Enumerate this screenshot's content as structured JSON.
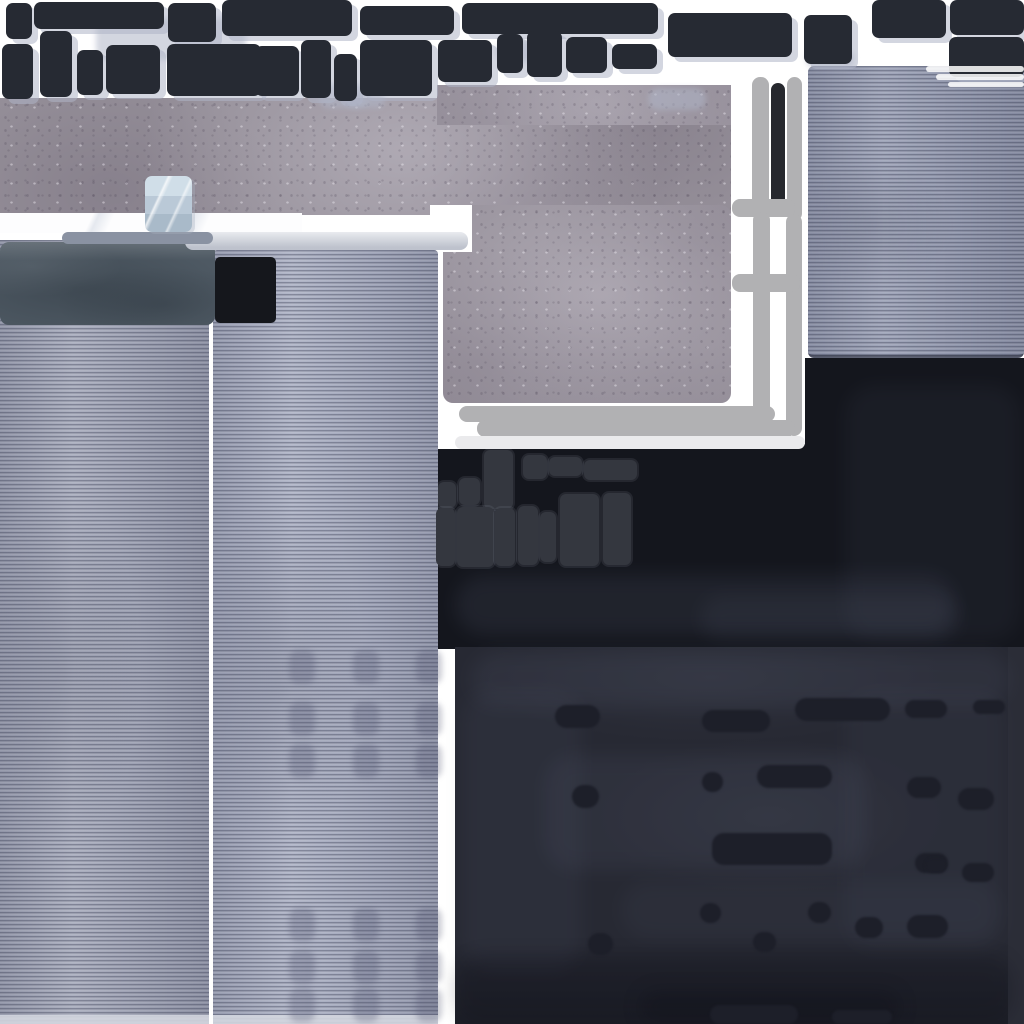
{
  "meta": {
    "asset_kind": "building-texture-atlas",
    "canvas": {
      "width": 1024,
      "height": 1024
    }
  },
  "palette": {
    "bg": "#ffffff",
    "frame": "#262a33",
    "frame_cluster": "#34373f",
    "frame_black": "#15171c",
    "win_shadow": "rgba(174,180,198,0.55)",
    "concrete": "#948e98",
    "panel_left": "#a6aabb",
    "panel_mid": "#acb1c4",
    "panel_right": "#9aa0b5",
    "edge_light": "#d3d6df",
    "cap": "#4e5963",
    "cube_top": "#d0dee8",
    "cube_mid": "#bac9d7",
    "cube_bot": "#a9bac9",
    "bar_blue": "#8a92a2",
    "bar_light": "#ced2db",
    "paint_gray": "#b1b1b3",
    "paint_light": "#eaeaec",
    "black_bar": "#26282e",
    "dark_band": "#14161d",
    "wash_light": "rgba(90,96,118,0.32)",
    "wash_dark": "rgba(10,12,20,0.45)",
    "bottom_base": "#272933",
    "bottom_dash": "#1d1f29",
    "bottom_edge": "#2b2d37"
  },
  "regions": {
    "concrete_band": {
      "x": 0,
      "y": 98,
      "w": 731,
      "h": 117
    },
    "concrete_step": {
      "x": 437,
      "y": 85,
      "w": 294,
      "h": 40
    },
    "concrete_square": {
      "x": 443,
      "y": 205,
      "w": 288,
      "h": 198
    },
    "white_band": {
      "x": 0,
      "y": 213,
      "w": 302,
      "h": 20
    },
    "white_notch": {
      "x": 430,
      "y": 205,
      "w": 42,
      "h": 47
    },
    "panel_right": {
      "x": 808,
      "y": 66,
      "w": 216,
      "h": 292
    },
    "panel_left": {
      "x": 0,
      "y": 240,
      "w": 209,
      "h": 784
    },
    "panel_mid": {
      "x": 213,
      "y": 250,
      "w": 225,
      "h": 774
    },
    "panel_left_edge": {
      "x": 0,
      "y": 1015,
      "w": 209,
      "h": 9
    },
    "panel_mid_edge": {
      "x": 213,
      "y": 1015,
      "w": 225,
      "h": 9
    },
    "cap": {
      "x": 0,
      "y": 242,
      "w": 215,
      "h": 83
    },
    "ac_unit": {
      "x": 145,
      "y": 176,
      "w": 47,
      "h": 56
    },
    "bar_blue": {
      "x": 62,
      "y": 232,
      "w": 151,
      "h": 12
    },
    "bar_light": {
      "x": 185,
      "y": 232,
      "w": 283,
      "h": 18
    },
    "dark_band_main": {
      "x": 438,
      "y": 449,
      "w": 586,
      "h": 200
    },
    "dark_band_right": {
      "x": 805,
      "y": 358,
      "w": 219,
      "h": 95
    },
    "dark_band_join": {
      "x": 733,
      "y": 444,
      "w": 74,
      "h": 8
    },
    "bottom_sheet": {
      "x": 455,
      "y": 647,
      "w": 569,
      "h": 377
    },
    "bottom_strip": {
      "x": 1008,
      "y": 647,
      "w": 16,
      "h": 377
    }
  },
  "windows": [
    {
      "style": "top",
      "x": 6,
      "y": 3,
      "w": 26,
      "h": 36,
      "pad": 6,
      "rows": [
        [
          1,
          [
            1
          ]
        ]
      ]
    },
    {
      "style": "top",
      "x": 34,
      "y": 2,
      "w": 130,
      "h": 27,
      "pad": 7,
      "rows": [
        [
          1,
          [
            1
          ]
        ]
      ]
    },
    {
      "style": "top",
      "x": 168,
      "y": 3,
      "w": 48,
      "h": 39,
      "pad": 8,
      "rows": [
        [
          1,
          [
            1
          ]
        ]
      ]
    },
    {
      "style": "top",
      "x": 222,
      "y": 0,
      "w": 130,
      "h": 36,
      "pad": 8,
      "rows": [
        [
          1,
          [
            2.2,
            1
          ]
        ]
      ]
    },
    {
      "style": "top",
      "x": 360,
      "y": 6,
      "w": 94,
      "h": 29,
      "pad": 6,
      "rows": [
        [
          1,
          [
            1.4,
            1,
            1.2
          ]
        ]
      ]
    },
    {
      "style": "top",
      "x": 462,
      "y": 3,
      "w": 196,
      "h": 31,
      "pad": 7,
      "rows": [
        [
          1,
          [
            2.6,
            0.6,
            2,
            1.5
          ]
        ]
      ]
    },
    {
      "style": "top",
      "x": 668,
      "y": 13,
      "w": 124,
      "h": 44,
      "pad": 8,
      "rows": [
        [
          1,
          [
            1,
            3.2
          ]
        ]
      ]
    },
    {
      "style": "top",
      "x": 804,
      "y": 15,
      "w": 48,
      "h": 49,
      "pad": 9,
      "rows": [
        [
          1,
          [
            1
          ]
        ]
      ]
    },
    {
      "style": "top",
      "x": 872,
      "y": 0,
      "w": 74,
      "h": 38,
      "pad": 8,
      "rows": [
        [
          1,
          [
            1
          ]
        ]
      ]
    },
    {
      "style": "top",
      "x": 950,
      "y": 0,
      "w": 74,
      "h": 35,
      "pad": 7,
      "rows": [
        [
          1,
          [
            1
          ]
        ]
      ]
    },
    {
      "style": "top",
      "x": 949,
      "y": 37,
      "w": 75,
      "h": 40,
      "pad": 8,
      "rows": [
        [
          1,
          [
            1
          ]
        ]
      ]
    },
    {
      "style": "top",
      "x": 2,
      "y": 44,
      "w": 31,
      "h": 55,
      "pad": 6,
      "rows": [
        [
          1.6,
          [
            1
          ]
        ],
        [
          1,
          [
            1
          ]
        ]
      ]
    },
    {
      "style": "top",
      "x": 40,
      "y": 31,
      "w": 32,
      "h": 66,
      "pad": 7,
      "rows": [
        [
          1,
          [
            1
          ]
        ]
      ]
    },
    {
      "style": "top",
      "x": 77,
      "y": 50,
      "w": 26,
      "h": 45,
      "pad": 6,
      "rows": [
        [
          1,
          [
            1
          ]
        ]
      ]
    },
    {
      "style": "top",
      "x": 106,
      "y": 45,
      "w": 54,
      "h": 49,
      "pad": 6,
      "rows": [
        [
          1,
          [
            1.3,
            1
          ]
        ],
        [
          1,
          [
            1.3,
            1
          ]
        ]
      ]
    },
    {
      "style": "top",
      "x": 167,
      "y": 44,
      "w": 94,
      "h": 52,
      "pad": 7,
      "rows": [
        [
          1,
          [
            1,
            2.2
          ]
        ],
        [
          1,
          [
            1,
            2.2
          ]
        ]
      ]
    },
    {
      "style": "top",
      "x": 255,
      "y": 46,
      "w": 44,
      "h": 50,
      "pad": 6,
      "rows": [
        [
          1,
          [
            1,
            1
          ]
        ],
        [
          1.2,
          [
            1
          ]
        ]
      ]
    },
    {
      "style": "top",
      "x": 301,
      "y": 40,
      "w": 30,
      "h": 58,
      "pad": 6,
      "rows": [
        [
          1,
          [
            1
          ]
        ]
      ]
    },
    {
      "style": "top",
      "x": 334,
      "y": 54,
      "w": 23,
      "h": 47,
      "pad": 5,
      "rows": [
        [
          1,
          [
            1
          ]
        ]
      ]
    },
    {
      "style": "top",
      "x": 360,
      "y": 40,
      "w": 72,
      "h": 56,
      "pad": 7,
      "rows": [
        [
          1,
          [
            1,
            1.1
          ]
        ]
      ]
    },
    {
      "style": "top",
      "x": 438,
      "y": 40,
      "w": 54,
      "h": 42,
      "pad": 7,
      "rows": [
        [
          1,
          [
            1
          ]
        ]
      ]
    },
    {
      "style": "top",
      "x": 497,
      "y": 34,
      "w": 26,
      "h": 39,
      "pad": 6,
      "rows": [
        [
          1,
          [
            1
          ]
        ]
      ]
    },
    {
      "style": "top",
      "x": 527,
      "y": 31,
      "w": 35,
      "h": 46,
      "pad": 6,
      "rows": [
        [
          1,
          [
            1
          ]
        ],
        [
          1,
          [
            1
          ]
        ]
      ]
    },
    {
      "style": "top",
      "x": 566,
      "y": 37,
      "w": 41,
      "h": 36,
      "pad": 7,
      "rows": [
        [
          1,
          [
            1
          ]
        ]
      ]
    },
    {
      "style": "top",
      "x": 612,
      "y": 44,
      "w": 45,
      "h": 25,
      "pad": 6,
      "rows": [
        [
          1,
          [
            1
          ]
        ]
      ]
    },
    {
      "style": "black",
      "x": 215,
      "y": 257,
      "w": 61,
      "h": 66,
      "pad": 6,
      "rows": [
        [
          1,
          [
            2.6,
            1
          ]
        ],
        [
          1,
          [
            2.6,
            1
          ]
        ],
        [
          1,
          [
            2.6,
            1
          ]
        ],
        [
          1,
          [
            2.6,
            1
          ]
        ]
      ]
    },
    {
      "style": "cluster",
      "x": 438,
      "y": 482,
      "w": 18,
      "h": 26,
      "pad": 4,
      "rows": [
        [
          1,
          [
            1
          ]
        ]
      ]
    },
    {
      "style": "cluster",
      "x": 459,
      "y": 478,
      "w": 21,
      "h": 27,
      "pad": 4,
      "rows": [
        [
          1,
          [
            1
          ]
        ]
      ]
    },
    {
      "style": "cluster",
      "x": 484,
      "y": 450,
      "w": 29,
      "h": 59,
      "pad": 4,
      "rows": [
        [
          1.6,
          [
            1
          ]
        ],
        [
          1,
          [
            1
          ]
        ]
      ]
    },
    {
      "style": "cluster",
      "x": 523,
      "y": 455,
      "w": 24,
      "h": 24,
      "pad": 4,
      "rows": [
        [
          1,
          [
            1
          ]
        ]
      ]
    },
    {
      "style": "cluster",
      "x": 549,
      "y": 457,
      "w": 33,
      "h": 19,
      "pad": 4,
      "rows": [
        [
          1,
          [
            1
          ]
        ]
      ]
    },
    {
      "style": "cluster",
      "x": 584,
      "y": 460,
      "w": 53,
      "h": 20,
      "pad": 4,
      "rows": [
        [
          1,
          [
            1
          ]
        ]
      ]
    },
    {
      "style": "cluster",
      "x": 436,
      "y": 508,
      "w": 19,
      "h": 58,
      "pad": 4,
      "rows": [
        [
          1,
          [
            1
          ]
        ]
      ]
    },
    {
      "style": "cluster",
      "x": 457,
      "y": 507,
      "w": 37,
      "h": 60,
      "pad": 5,
      "rows": [
        [
          1.2,
          [
            1
          ]
        ],
        [
          1,
          [
            1,
            1
          ]
        ]
      ]
    },
    {
      "style": "cluster",
      "x": 495,
      "y": 508,
      "w": 20,
      "h": 58,
      "pad": 4,
      "rows": [
        [
          1,
          [
            1
          ]
        ],
        [
          1,
          [
            1
          ]
        ],
        [
          1,
          [
            1
          ]
        ]
      ]
    },
    {
      "style": "cluster",
      "x": 518,
      "y": 506,
      "w": 20,
      "h": 59,
      "pad": 4,
      "rows": [
        [
          1,
          [
            1
          ]
        ]
      ]
    },
    {
      "style": "cluster",
      "x": 540,
      "y": 512,
      "w": 16,
      "h": 50,
      "pad": 4,
      "rows": [
        [
          1,
          [
            1
          ]
        ]
      ]
    },
    {
      "style": "cluster",
      "x": 560,
      "y": 494,
      "w": 39,
      "h": 72,
      "pad": 5,
      "rows": [
        [
          1,
          [
            1
          ]
        ],
        [
          1,
          [
            1
          ]
        ]
      ]
    },
    {
      "style": "cluster",
      "x": 603,
      "y": 493,
      "w": 28,
      "h": 72,
      "pad": 5,
      "rows": [
        [
          1,
          [
            1
          ]
        ]
      ]
    }
  ],
  "marks": [
    {
      "x": 752,
      "y": 77,
      "w": 17,
      "h": 137,
      "kind": "gray"
    },
    {
      "x": 771,
      "y": 83,
      "w": 14,
      "h": 130,
      "kind": "black"
    },
    {
      "x": 787,
      "y": 77,
      "w": 15,
      "h": 144,
      "kind": "gray"
    },
    {
      "x": 732,
      "y": 199,
      "w": 63,
      "h": 18,
      "kind": "gray"
    },
    {
      "x": 753,
      "y": 212,
      "w": 17,
      "h": 225,
      "kind": "gray"
    },
    {
      "x": 786,
      "y": 214,
      "w": 16,
      "h": 222,
      "kind": "gray"
    },
    {
      "x": 732,
      "y": 274,
      "w": 68,
      "h": 18,
      "kind": "gray"
    },
    {
      "x": 459,
      "y": 406,
      "w": 316,
      "h": 16,
      "kind": "gray"
    },
    {
      "x": 477,
      "y": 420,
      "w": 318,
      "h": 17,
      "kind": "gray"
    },
    {
      "x": 455,
      "y": 436,
      "w": 350,
      "h": 13,
      "kind": "light"
    },
    {
      "x": 926,
      "y": 66,
      "w": 98,
      "h": 6,
      "kind": "fade"
    },
    {
      "x": 936,
      "y": 74,
      "w": 88,
      "h": 6,
      "kind": "fade"
    },
    {
      "x": 948,
      "y": 82,
      "w": 76,
      "h": 5,
      "kind": "fade"
    }
  ],
  "shadow_blobs": [
    [
      96,
      18,
      150,
      42
    ],
    [
      318,
      84,
      52,
      24
    ],
    [
      648,
      88,
      58,
      22
    ],
    [
      806,
      50,
      48,
      18
    ],
    [
      496,
      40,
      44,
      22
    ],
    [
      345,
      92,
      40,
      16
    ]
  ],
  "panel_blob_grid": {
    "cols": [
      289,
      353,
      416
    ],
    "rows": [
      650,
      702,
      744,
      908,
      950,
      988
    ],
    "w": 26,
    "h": 34
  },
  "dashes": [
    [
      555,
      705,
      45,
      23
    ],
    [
      702,
      710,
      68,
      22
    ],
    [
      795,
      698,
      95,
      23
    ],
    [
      905,
      700,
      42,
      18
    ],
    [
      973,
      700,
      32,
      14
    ],
    [
      702,
      772,
      21,
      20
    ],
    [
      757,
      765,
      75,
      23
    ],
    [
      572,
      785,
      27,
      23
    ],
    [
      907,
      777,
      34,
      21
    ],
    [
      958,
      788,
      36,
      22
    ],
    [
      712,
      833,
      120,
      32
    ],
    [
      915,
      853,
      33,
      20
    ],
    [
      962,
      863,
      32,
      19
    ],
    [
      925,
      858,
      22,
      15
    ],
    [
      700,
      903,
      21,
      20
    ],
    [
      808,
      902,
      23,
      21
    ],
    [
      855,
      917,
      28,
      21
    ],
    [
      907,
      915,
      41,
      23
    ],
    [
      753,
      932,
      23,
      20
    ],
    [
      588,
      933,
      25,
      22
    ],
    [
      710,
      1005,
      88,
      19
    ],
    [
      832,
      1010,
      60,
      14
    ]
  ],
  "washes": [
    {
      "x": 455,
      "y": 575,
      "w": 500,
      "h": 60,
      "kind": "light",
      "o": 0.55
    },
    {
      "x": 700,
      "y": 595,
      "w": 260,
      "h": 45,
      "kind": "light",
      "o": 0.4
    },
    {
      "x": 845,
      "y": 385,
      "w": 175,
      "h": 255,
      "kind": "light",
      "o": 0.3
    },
    {
      "x": 470,
      "y": 652,
      "w": 540,
      "h": 55,
      "kind": "light",
      "o": 0.45
    },
    {
      "x": 545,
      "y": 755,
      "w": 320,
      "h": 115,
      "kind": "light",
      "o": 0.45
    },
    {
      "x": 462,
      "y": 690,
      "w": 120,
      "h": 280,
      "kind": "light",
      "o": 0.35
    },
    {
      "x": 845,
      "y": 690,
      "w": 160,
      "h": 260,
      "kind": "light",
      "o": 0.28
    },
    {
      "x": 620,
      "y": 880,
      "w": 380,
      "h": 60,
      "kind": "light",
      "o": 0.3
    },
    {
      "x": 455,
      "y": 955,
      "w": 560,
      "h": 70,
      "kind": "dark",
      "o": 0.45
    },
    {
      "x": 640,
      "y": 990,
      "w": 260,
      "h": 34,
      "kind": "dark",
      "o": 0.55
    }
  ]
}
